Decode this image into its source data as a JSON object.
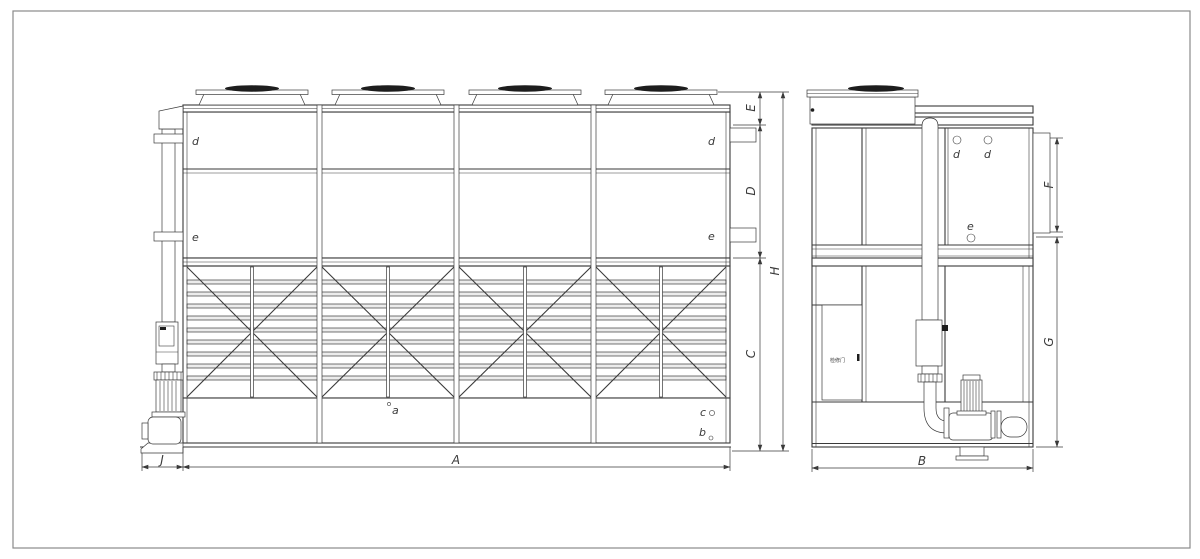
{
  "front_view": {
    "dims": {
      "A": "A",
      "C": "C",
      "D": "D",
      "E": "E",
      "H": "H",
      "J": "J"
    },
    "parts": {
      "a": "a",
      "b": "b",
      "c": "c",
      "d_left": "d",
      "d_right": "d",
      "e_left": "e",
      "e_right": "e"
    }
  },
  "side_view": {
    "dims": {
      "B": "B",
      "F": "F",
      "G": "G"
    },
    "parts": {
      "d1": "d",
      "d2": "d",
      "e": "e"
    },
    "door_label": "检修门"
  },
  "colors": {
    "line": "#3a3a3a",
    "slat_fill": "#ececec",
    "fan_dark": "#1d1d1d",
    "frame": "#8a8a8a",
    "background": "#ffffff"
  }
}
